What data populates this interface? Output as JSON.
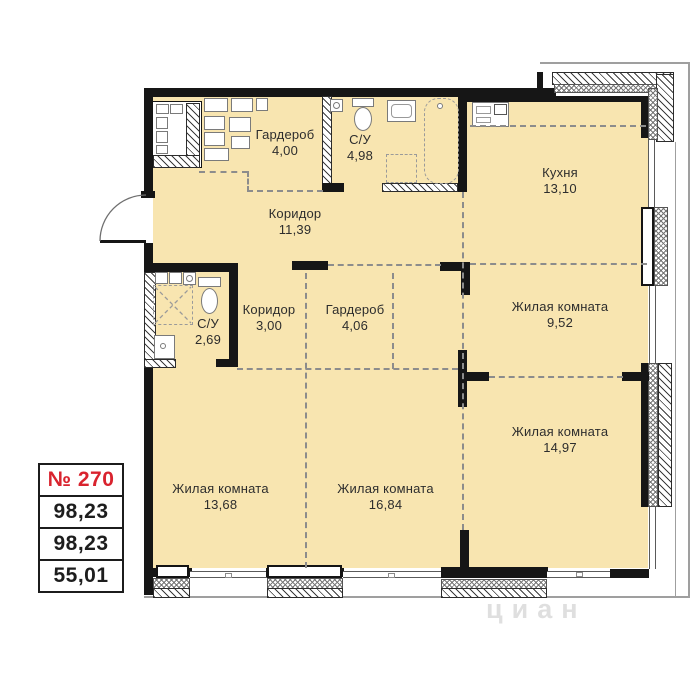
{
  "unit": {
    "number": "№ 270",
    "total_area": "98,23",
    "reduced_area": "98,23",
    "living_area": "55,01"
  },
  "rooms": [
    {
      "id": "wardrobe-top",
      "name": "Гардероб",
      "area": "4,00"
    },
    {
      "id": "bathroom-top",
      "name": "С/У",
      "area": "4,98"
    },
    {
      "id": "kitchen",
      "name": "Кухня",
      "area": "13,10"
    },
    {
      "id": "corridor-main",
      "name": "Коридор",
      "area": "11,39"
    },
    {
      "id": "corridor-small",
      "name": "Коридор",
      "area": "3,00"
    },
    {
      "id": "wardrobe-mid",
      "name": "Гардероб",
      "area": "4,06"
    },
    {
      "id": "bathroom-small",
      "name": "С/У",
      "area": "2,69"
    },
    {
      "id": "living-1",
      "name": "Жилая комната",
      "area": "9,52"
    },
    {
      "id": "living-2",
      "name": "Жилая комната",
      "area": "14,97"
    },
    {
      "id": "living-3",
      "name": "Жилая комната",
      "area": "13,68"
    },
    {
      "id": "living-4",
      "name": "Жилая комната",
      "area": "16,84"
    }
  ],
  "watermark": "циан",
  "colors": {
    "room_fill": "#f8e5b0",
    "wall": "#161616",
    "unit_number_red": "#d9232e",
    "dash": "#8c8c8c"
  }
}
